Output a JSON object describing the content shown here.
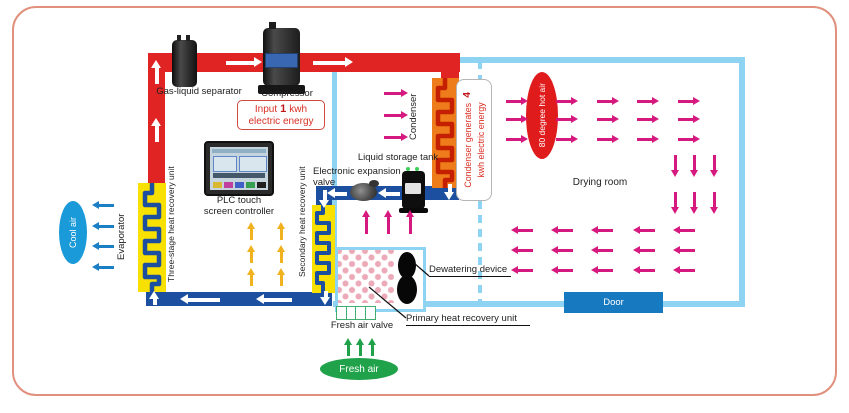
{
  "labels": {
    "gas_liquid_separator": "Gas-liquid separator",
    "compressor": "Compressor",
    "condenser": "Condenser",
    "evaporator": "Evaporator",
    "cool_air": "Cool air",
    "fresh_air": "Fresh air",
    "fresh_air_valve": "Fresh air valve",
    "hot_air": "80 degree hot air",
    "drying_room": "Drying room",
    "door": "Door",
    "liquid_storage_tank": "Liquid storage tank",
    "expansion_valve_line1": "Electronic expansion",
    "expansion_valve_line2": "valve",
    "plc_line1": "PLC touch",
    "plc_line2": "screen controller",
    "three_stage_unit": "Three-stage heat recovery unit",
    "secondary_unit": "Secondary heat recovery unit",
    "primary_unit": "Primary heat recovery unit",
    "dewatering_device": "Dewatering device"
  },
  "energy": {
    "input_prefix": "Input",
    "input_value": "1",
    "input_suffix": "kwh",
    "input_line2": "electric energy",
    "generate_prefix": "Condenser generates",
    "generate_value": "4",
    "generate_line2": "kwh electric energy"
  },
  "colors": {
    "hot": "#e02424",
    "cold": "#1c4f9f",
    "wall": "#8ed4f2",
    "magenta": "#d6197f",
    "coolarrow": "#1a7fc4",
    "coolell": "#1a9ad8",
    "green": "#1fa24a",
    "unit": "#f8e000",
    "yellowarrow": "#f0b21e",
    "condbody": "#ef7c1a",
    "condcoil": "#c41f00",
    "door": "#1779c0",
    "hotell": "#e01b1c",
    "redtext": "#d93025",
    "frame": "#e0907c"
  }
}
